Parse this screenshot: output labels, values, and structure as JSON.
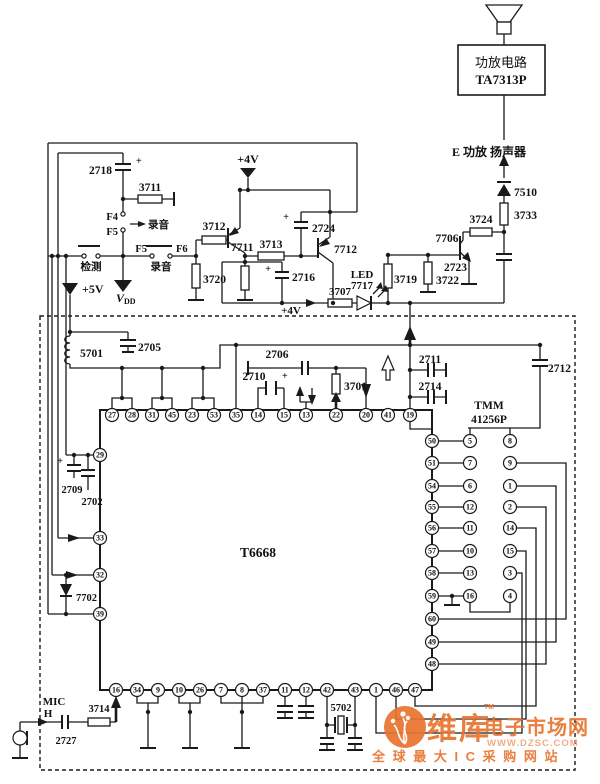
{
  "power_amp": {
    "box_line1": "功放电路",
    "box_line2": "TA7313P",
    "node_label": "E 功放  扬声器"
  },
  "vdd": {
    "v": "V",
    "sub": "DD"
  },
  "labels": [
    {
      "id": "amp1",
      "t": "功放电路"
    },
    {
      "id": "amp2",
      "t": "TA7313P"
    },
    {
      "id": "eline",
      "t": "E 功放  扬声器"
    },
    {
      "id": "d7510",
      "t": "7510"
    },
    {
      "id": "r3733",
      "t": "3733"
    },
    {
      "id": "r3724",
      "t": "3724"
    },
    {
      "id": "q7706",
      "t": "7706"
    },
    {
      "id": "c2723",
      "t": "2723"
    },
    {
      "id": "r3722",
      "t": "3722"
    },
    {
      "id": "r3719",
      "t": "3719"
    },
    {
      "id": "led1",
      "t": "LED"
    },
    {
      "id": "led2",
      "t": "7717"
    },
    {
      "id": "r3707",
      "t": "3707"
    },
    {
      "id": "p4vw",
      "t": "+4V"
    },
    {
      "id": "c2716",
      "t": "2716"
    },
    {
      "id": "c2718",
      "t": "2718"
    },
    {
      "id": "r3711",
      "t": "3711"
    },
    {
      "id": "f4",
      "t": "F4"
    },
    {
      "id": "f5a",
      "t": "F5"
    },
    {
      "id": "ly1",
      "t": "录音"
    },
    {
      "id": "jc",
      "t": "检测"
    },
    {
      "id": "f5b",
      "t": "F5"
    },
    {
      "id": "f6",
      "t": "F6"
    },
    {
      "id": "ly2",
      "t": "录音"
    },
    {
      "id": "p5v",
      "t": "+5V"
    },
    {
      "id": "p4vt",
      "t": "+4V"
    },
    {
      "id": "r3712",
      "t": "3712"
    },
    {
      "id": "q7711",
      "t": "7711"
    },
    {
      "id": "r3713",
      "t": "3713"
    },
    {
      "id": "c2724",
      "t": "2724"
    },
    {
      "id": "q7712",
      "t": "7712"
    },
    {
      "id": "r3720",
      "t": "3720"
    },
    {
      "id": "l5701",
      "t": "5701"
    },
    {
      "id": "c2705",
      "t": "2705"
    },
    {
      "id": "c2710",
      "t": "2710"
    },
    {
      "id": "c2706",
      "t": "2706"
    },
    {
      "id": "r3701",
      "t": "3701"
    },
    {
      "id": "c2711",
      "t": "2711"
    },
    {
      "id": "c2714",
      "t": "2714"
    },
    {
      "id": "c2712",
      "t": "2712"
    },
    {
      "id": "tmm1",
      "t": "TMM"
    },
    {
      "id": "tmm2",
      "t": "41256P"
    },
    {
      "id": "t6668",
      "t": "T6668"
    },
    {
      "id": "c2709",
      "t": "2709"
    },
    {
      "id": "c2702",
      "t": "2702"
    },
    {
      "id": "d7702",
      "t": "7702"
    },
    {
      "id": "mic1",
      "t": "MIC"
    },
    {
      "id": "mic2",
      "t": "H"
    },
    {
      "id": "c2727",
      "t": "2727"
    },
    {
      "id": "r3714",
      "t": "3714"
    },
    {
      "id": "x5702",
      "t": "5702"
    },
    {
      "id": "pl2718",
      "t": "+"
    },
    {
      "id": "pl2724",
      "t": "+"
    },
    {
      "id": "pl2716",
      "t": "+"
    },
    {
      "id": "pl2710",
      "t": "+"
    },
    {
      "id": "pl2709",
      "t": "+"
    }
  ],
  "t6668_pins": {
    "top": [
      "27",
      "28",
      "31",
      "45",
      "23",
      "53",
      "35",
      "14",
      "15",
      "13",
      "22",
      "20",
      "41",
      "19"
    ],
    "left": [
      "29",
      "33",
      "32",
      "39"
    ],
    "right": [
      "50",
      "51",
      "54",
      "55",
      "56",
      "57",
      "58",
      "59",
      "60",
      "49",
      "48"
    ],
    "bottom": [
      "16",
      "34",
      "9",
      "10",
      "26",
      "7",
      "8",
      "37",
      "11",
      "12",
      "42",
      "43",
      "1",
      "46",
      "47"
    ]
  },
  "tmm_pins": {
    "left": [
      "5",
      "7",
      "6",
      "12",
      "11",
      "10",
      "13",
      "16"
    ],
    "right": [
      "8",
      "9",
      "1",
      "2",
      "14",
      "15",
      "3",
      "4"
    ]
  },
  "watermark": {
    "brand1": "维库",
    "brand2": "电子市场网",
    "tm": "TM",
    "url": "WWW.DZSC.COM",
    "slogan": "全 球 最 大 I C 采 购 网 站",
    "color": "#e8742f",
    "color_light": "#f2a47e"
  },
  "colors": {
    "ink": "#1a1a1a",
    "paper": "#ffffff"
  }
}
